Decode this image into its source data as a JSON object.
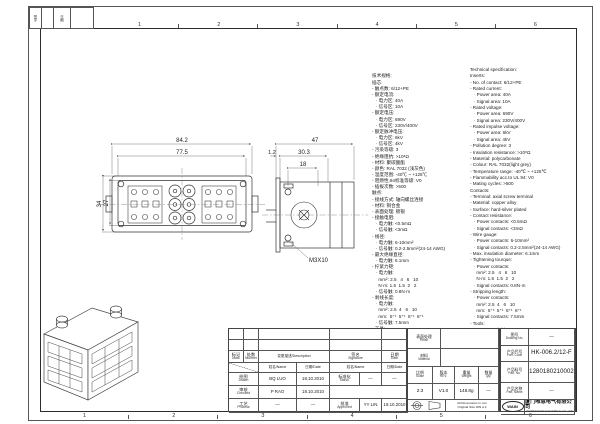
{
  "frame": {
    "zones": [
      {
        "n": "1"
      },
      {
        "n": "2"
      },
      {
        "n": "3"
      },
      {
        "n": "4"
      },
      {
        "n": "5"
      },
      {
        "n": "6"
      }
    ],
    "corner_table": {
      "col1": "签字",
      "col2": "日期"
    }
  },
  "views": {
    "front": {
      "dim_w_outer": "84.2",
      "dim_w_inner": "77.5",
      "dim_h_outer": "34",
      "dim_h_inner": "27"
    },
    "side": {
      "dim_w": "47",
      "dim_flange": "1.2",
      "dim_depth": "30.3",
      "dim_inner": "18",
      "screw_label": "M3X10"
    }
  },
  "spec_zh": {
    "lines": [
      "技术规格:",
      "插芯:",
      "- 触点数: 6/12+PE",
      "- 额定电流:",
      "   · 电力区: 40A",
      "   · 信号区: 10A",
      "- 额定电压:",
      "   · 电力区: 690V",
      "   · 信号区: 230V/400V",
      "- 额定脉冲电压:",
      "   · 电力区: 6kV",
      "   · 信号区: 4kV",
      "- 污染等级: 3",
      "- 绝缘阻抗: >10⁸Ω",
      "- 材料: 聚碳酸酯",
      "- 颜色: RAL 7032 (浅灰色)",
      "- 温度范围: -40℃ ~ +125℃",
      "- 阻燃性,94标准等级: V0",
      "- 插拔次数: >500",
      "触点:",
      "- 接线方式: 轴向螺丝连接",
      "- 材料: 铜合金",
      "- 表面处理: 镀银",
      "- 接触电阻:",
      "   · 电力触: <0.5mΩ",
      "   · 信号触: <3mΩ",
      "- 线径:",
      "   · 电力触: 6-10mm²",
      "   · 信号触: 0.2-2.5mm²(24-14 AWG)",
      "- 最大绝缘直径:",
      "   · 电力触: 6.1mm",
      "- 拧紧力矩:",
      "   · 电力触:",
      "     mm²: 2.5   4   6   10",
      "     N·m: 1.5  1.5  2   2",
      "   · 信号触: 0.8N·m",
      "- 剥线长度:",
      "   · 电力触:",
      "     mm²: 2.5  4   6   10",
      "     mm:  5⁺¹  5⁺¹  8⁺¹  8⁺¹",
      "   · 信号触: 7.5mm",
      "- 工具:",
      "   · 内六角扳手: SW-2*40"
    ]
  },
  "spec_en": {
    "lines": [
      "Technical specification:",
      "Inserts:",
      "- No. of contact: 6/12+PE",
      "- Rated current:",
      "   · Power area: 40A",
      "   · Signal area: 10A",
      "- Rated voltage:",
      "   · Power area: 690V",
      "   · Signal area: 230V/400V",
      "- Rated impulse voltage:",
      "   · Power area: 6kV",
      "   · Signal area: 4kV",
      "- Pollution degree: 3",
      "- Insulation resistance: >10⁸Ω",
      "- Material: polycarbonate",
      "- Colour: RAL 7032(light grey)",
      "- Temperature range: -40℃ ~ +125℃",
      "- Flammability acc.to UL 94: V0",
      "- Mating cycles: >500",
      "Contacts:",
      "- Terminal: axial screw terminal",
      "- Material: copper alloy",
      "- Surface: hard-silver plated",
      "- Contact resistance:",
      "   · Power contacts: <0.5mΩ",
      "   · Signal contacts: <3mΩ",
      "- Wire gauge:",
      "   · Power contacts: 6-10mm²",
      "   · Signal contacts: 0.2-2.5mm²(24-14 AWG)",
      "- Max. insulation diameter: 6.1mm",
      "- Tightening tourque:",
      "   · Power contacts:",
      "     mm²: 2.5   4   6   10",
      "     N·m: 1.5  1.5  2   2",
      "   · Signal contacts: 0.8N·m",
      "- Stripping length:",
      "   · Power contacts:",
      "     mm²: 2.5  4   6   10",
      "     mm:  5⁺¹  5⁺¹  8⁺¹  8⁺¹",
      "   · Signal contacts: 7.5mm",
      "- Tools:",
      "   · Hexagonal driver: SW-2*40"
    ]
  },
  "sig_table": {
    "headers": {
      "mark_zh": "标记",
      "mark_en": "Mark",
      "number_zh": "处数",
      "number_en": "Number",
      "description": "变更描述/Description",
      "signature_zh": "签名",
      "signature_en": "Signature",
      "date_zh": "日期",
      "date_en": "Date",
      "name_sub": "姓名/Name",
      "date_sub": "日期/Date"
    },
    "rows": {
      "drawn": {
        "zh": "绘图",
        "en": "Drawn",
        "name": "BQ LUO",
        "date": "18.10.2010"
      },
      "checked": {
        "zh": "审核",
        "en": "Checked",
        "name": "P RAO",
        "date": "18.10.2010"
      },
      "process": {
        "zh": "工艺",
        "en": "Process",
        "name": "—",
        "date": "—"
      },
      "stand": {
        "zh": "标准化",
        "en": "Stand.",
        "name": "—",
        "date": "—"
      },
      "approved": {
        "zh": "批准",
        "en": "Approved",
        "name": "YY LIN",
        "date": "18.10.2010"
      }
    }
  },
  "title_block": {
    "finish": {
      "zh": "表面处理",
      "en": "Finish",
      "value": ""
    },
    "material": {
      "zh": "材料",
      "en": "Material",
      "value": ""
    },
    "scale": {
      "zh": "比例",
      "en": "Scale",
      "value": "2:3"
    },
    "rev": {
      "zh": "版本",
      "en": "REV.",
      "value": "V1.0"
    },
    "weight": {
      "zh": "重量",
      "en": "Weight",
      "value": "148.8g"
    },
    "qty": {
      "zh": "数量",
      "en": "Qty.",
      "value": "—"
    },
    "drawing_no": {
      "zh": "图号",
      "en": "Drawing No.",
      "value": "—"
    },
    "part_code": {
      "zh": "产品代号",
      "en": "Part. Code",
      "value": "HK-006.2/12-F"
    },
    "part_no": {
      "zh": "产品料号",
      "en": "Part. No.",
      "value": "1280180210002"
    },
    "part_name": {
      "zh": "产品名称",
      "en": "Part. Name",
      "value": "—"
    },
    "note_line1": "All Dimensions in mm",
    "note_line2": "Original Size DIN A 4",
    "logo": "WAIN",
    "company_zh": "厦门唯恩电气有限公司",
    "company_en": "XIAMEN WAIN ELECTRICAL CO.,LTD"
  }
}
